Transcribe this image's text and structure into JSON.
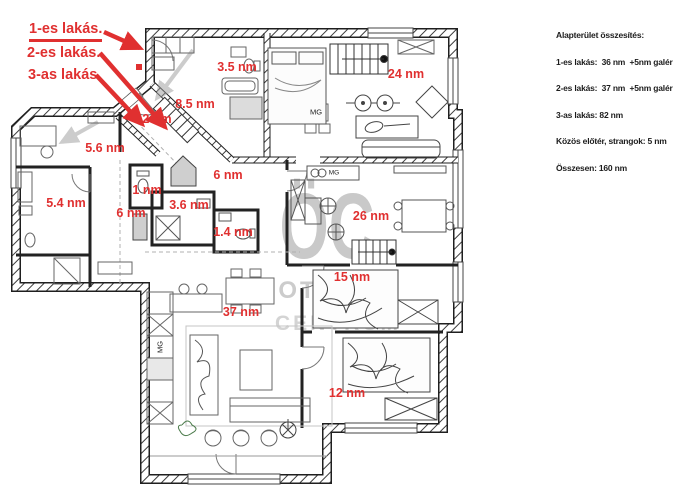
{
  "callouts": {
    "items": [
      {
        "label": "1-es lakás."
      },
      {
        "label": "2-es lakás."
      },
      {
        "label": "3-as lakás."
      }
    ]
  },
  "plan": {
    "room_labels": [
      {
        "text": "3.5 nm"
      },
      {
        "text": "24 nm"
      },
      {
        "text": "8.5 nm"
      },
      {
        "text": "2 nm"
      },
      {
        "text": "5.6 nm"
      },
      {
        "text": "6 nm"
      },
      {
        "text": "1 nm"
      },
      {
        "text": "5.4 nm"
      },
      {
        "text": "3.6 nm"
      },
      {
        "text": "6 nm"
      },
      {
        "text": "1.4 nm"
      },
      {
        "text": "26 nm"
      },
      {
        "text": "15 nm"
      },
      {
        "text": "37 nm"
      },
      {
        "text": "12 nm"
      }
    ],
    "appliance_labels": [
      {
        "text": "MG"
      },
      {
        "text": "MG"
      },
      {
        "text": "MG"
      }
    ]
  },
  "watermark": {
    "line1": "ÖC",
    "line2": "OTTHON",
    "line3": "CENTRUM"
  },
  "summary": {
    "title": "Alapterület összesítés:",
    "lines": [
      "1-es lakás:  36 nm  +5nm galéria",
      "2-es lakás:  37 nm  +5nm galéria",
      "3-as lakás: 82 nm",
      "Közös előtér, strangok: 5 nm",
      "Összesen: 160 nm"
    ]
  },
  "colors": {
    "red": "#e03030",
    "wall": "#1f1f1f",
    "watermark": "#c6c6c6"
  }
}
